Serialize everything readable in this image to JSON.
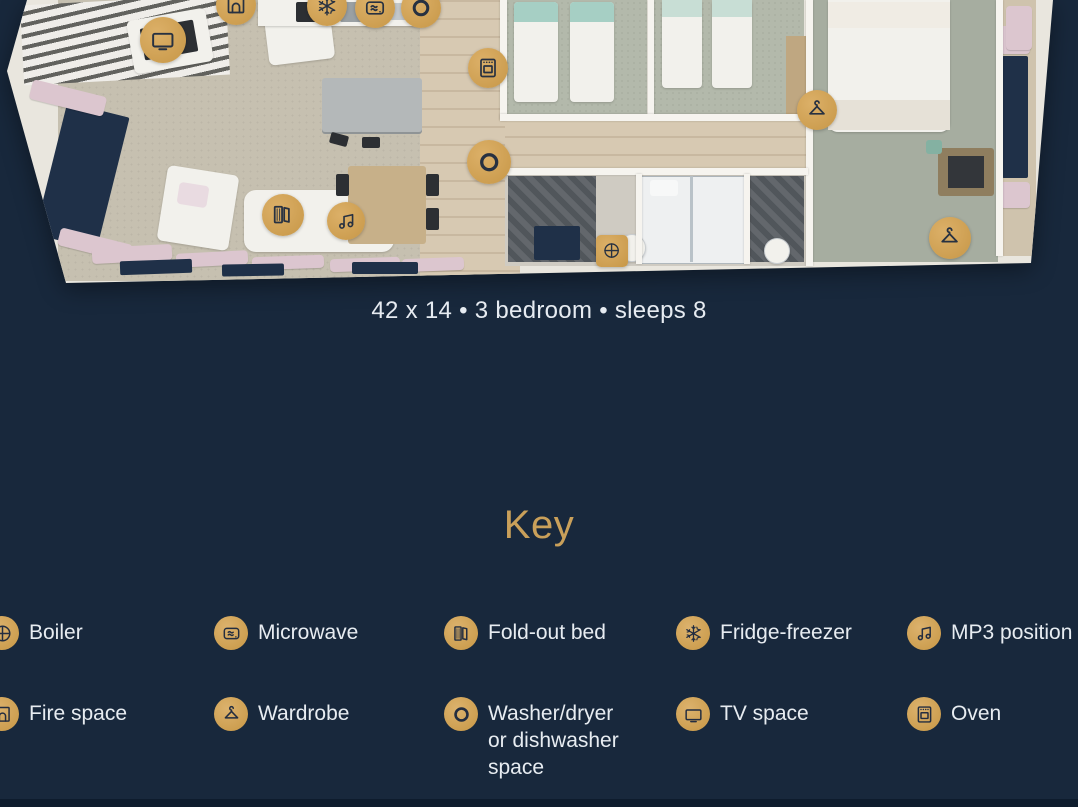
{
  "page": {
    "background_color": "#18283c",
    "accent_gold": "#cfa355",
    "text_color": "#e7ecf1"
  },
  "floorplan": {
    "caption": "42 x 14 • 3 bedroom • sleeps 8",
    "markers": [
      {
        "icon": "tv",
        "x": 163,
        "y": 40,
        "size": 46
      },
      {
        "icon": "fire",
        "x": 236,
        "y": 5,
        "size": 40
      },
      {
        "icon": "fridge",
        "x": 327,
        "y": 6,
        "size": 40
      },
      {
        "icon": "microwave",
        "x": 375,
        "y": 8,
        "size": 40
      },
      {
        "icon": "washer",
        "x": 421,
        "y": 8,
        "size": 40
      },
      {
        "icon": "oven",
        "x": 488,
        "y": 68,
        "size": 40
      },
      {
        "icon": "washer",
        "x": 489,
        "y": 162,
        "size": 44
      },
      {
        "icon": "foldbed",
        "x": 283,
        "y": 215,
        "size": 42
      },
      {
        "icon": "mp3",
        "x": 346,
        "y": 221,
        "size": 38
      },
      {
        "icon": "boiler",
        "x": 612,
        "y": 251,
        "size": 32,
        "shape": "square"
      },
      {
        "icon": "wardrobe",
        "x": 817,
        "y": 110,
        "size": 40
      },
      {
        "icon": "wardrobe",
        "x": 950,
        "y": 238,
        "size": 42
      }
    ]
  },
  "key": {
    "title": "Key",
    "items": [
      {
        "icon": "boiler",
        "label": "Boiler"
      },
      {
        "icon": "microwave",
        "label": "Microwave"
      },
      {
        "icon": "foldbed",
        "label": "Fold-out bed"
      },
      {
        "icon": "fridge",
        "label": "Fridge-freezer"
      },
      {
        "icon": "mp3",
        "label": "MP3 position"
      },
      {
        "icon": "fire",
        "label": "Fire space"
      },
      {
        "icon": "wardrobe",
        "label": "Wardrobe"
      },
      {
        "icon": "washer",
        "label": "Washer/dryer or dishwasher space"
      },
      {
        "icon": "tv",
        "label": "TV space"
      },
      {
        "icon": "oven",
        "label": "Oven"
      }
    ]
  }
}
